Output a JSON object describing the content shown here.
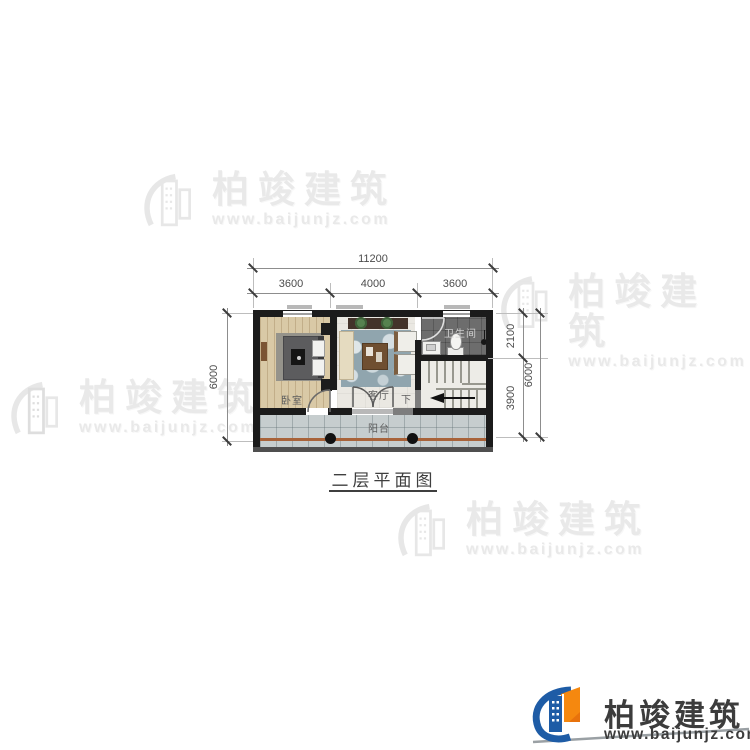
{
  "watermark": {
    "brand": "柏竣建筑",
    "url": "www.baijunjz.com"
  },
  "logo": {
    "brand": "柏竣建筑",
    "url": "www.baijunjz.com"
  },
  "plan": {
    "title": "二层平面图",
    "rooms": {
      "bedroom": "卧室",
      "living_room": "客厅",
      "bathroom": "卫生间",
      "balcony": "阳台",
      "stairs_down": "下"
    },
    "dimensions": {
      "top_total": "11200",
      "top_segments": [
        "3600",
        "4000",
        "3600"
      ],
      "left_total": "6000",
      "right_inner_top": "2100",
      "right_inner_bottom": "3900",
      "right_total": "6000"
    }
  },
  "colors": {
    "logo_blue": "#1e5ca6",
    "logo_orange": "#f5880f",
    "balcony_rail": "#a8633a",
    "wall": "#1b1b1b"
  }
}
